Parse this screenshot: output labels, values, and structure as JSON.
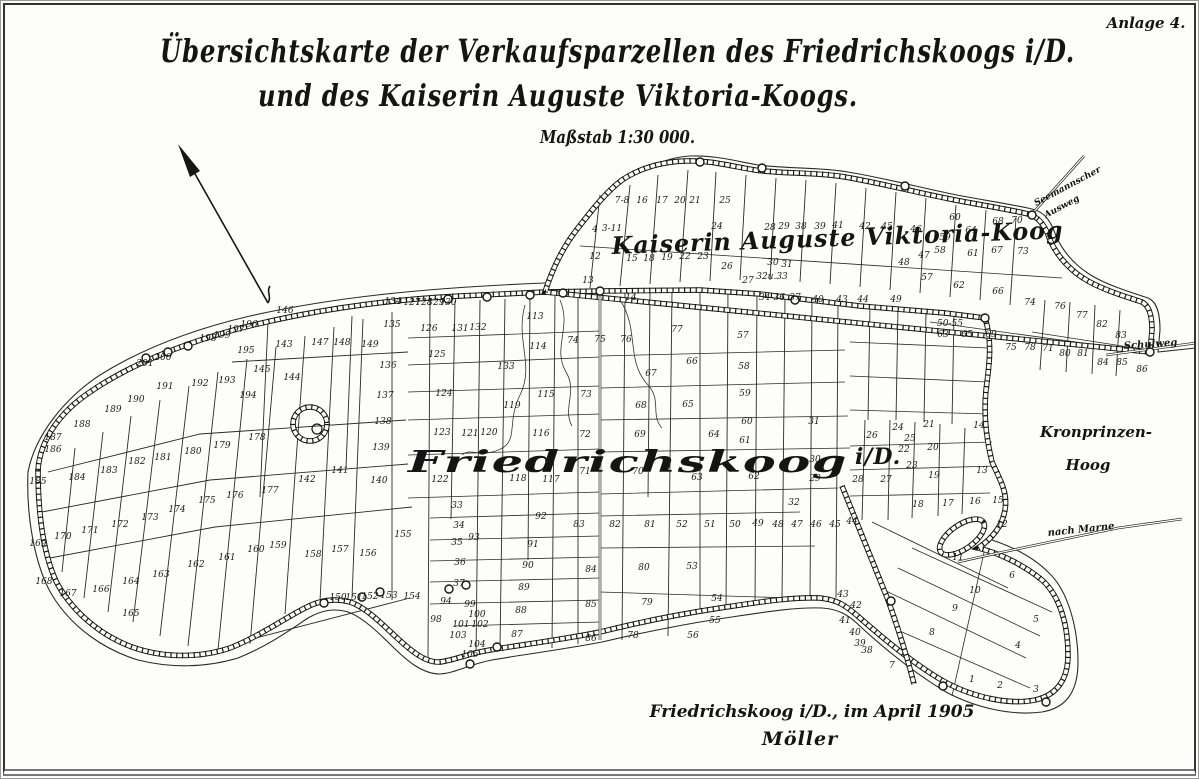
{
  "frame": {
    "annotation": "Anlage 4."
  },
  "title": {
    "line1": "Übersichtskarte der Verkaufsparzellen des Friedrichskoogs i/D.",
    "line2": "und des Kaiserin Auguste Viktoria-Koogs.",
    "scale": "Maßstab 1:30 000."
  },
  "footer": {
    "place_date": "Friedrichskoog i/D., im April 1905",
    "signature": "Möller"
  },
  "map": {
    "labels": {
      "kav_koog": "Kaiserin Auguste Viktoria-Koog",
      "friedrichskoog": "Friedrichskoog",
      "fk_suffix": "i/D.",
      "kronprinzen_line1": "Kronprinzen-",
      "kronprinzen_line2": "Hoog",
      "nach_marne": "nach Marne",
      "schulweg": "Schulweg",
      "ausweg_line1": "Seemannscher",
      "ausweg_line2": "Ausweg"
    },
    "parcels": [
      {
        "n": "1",
        "x": 972,
        "y": 682
      },
      {
        "n": "2",
        "x": 1000,
        "y": 688
      },
      {
        "n": "3",
        "x": 1036,
        "y": 692
      },
      {
        "n": "4",
        "x": 1018,
        "y": 648
      },
      {
        "n": "5",
        "x": 1036,
        "y": 622
      },
      {
        "n": "6",
        "x": 1012,
        "y": 578
      },
      {
        "n": "7",
        "x": 892,
        "y": 668
      },
      {
        "n": "8",
        "x": 932,
        "y": 635
      },
      {
        "n": "9",
        "x": 955,
        "y": 611
      },
      {
        "n": "10",
        "x": 975,
        "y": 593
      },
      {
        "n": "11",
        "x": 958,
        "y": 560
      },
      {
        "n": "12",
        "x": 1002,
        "y": 527
      },
      {
        "n": "13",
        "x": 982,
        "y": 473
      },
      {
        "n": "14",
        "x": 979,
        "y": 428
      },
      {
        "n": "15",
        "x": 998,
        "y": 503
      },
      {
        "n": "16",
        "x": 975,
        "y": 504
      },
      {
        "n": "17",
        "x": 948,
        "y": 506
      },
      {
        "n": "18",
        "x": 918,
        "y": 507
      },
      {
        "n": "19",
        "x": 934,
        "y": 478
      },
      {
        "n": "20",
        "x": 933,
        "y": 450
      },
      {
        "n": "21",
        "x": 929,
        "y": 427
      },
      {
        "n": "22",
        "x": 904,
        "y": 452
      },
      {
        "n": "23",
        "x": 912,
        "y": 468
      },
      {
        "n": "24",
        "x": 898,
        "y": 430
      },
      {
        "n": "25",
        "x": 910,
        "y": 441
      },
      {
        "n": "26",
        "x": 872,
        "y": 438
      },
      {
        "n": "27",
        "x": 886,
        "y": 482
      },
      {
        "n": "28",
        "x": 858,
        "y": 482
      },
      {
        "n": "29",
        "x": 815,
        "y": 481
      },
      {
        "n": "30",
        "x": 815,
        "y": 462
      },
      {
        "n": "31",
        "x": 814,
        "y": 424
      },
      {
        "n": "32",
        "x": 794,
        "y": 505
      },
      {
        "n": "33",
        "x": 457,
        "y": 508
      },
      {
        "n": "34",
        "x": 459,
        "y": 528
      },
      {
        "n": "35",
        "x": 457,
        "y": 545
      },
      {
        "n": "36",
        "x": 460,
        "y": 565
      },
      {
        "n": "37",
        "x": 459,
        "y": 586
      },
      {
        "n": "38",
        "x": 867,
        "y": 653
      },
      {
        "n": "39",
        "x": 860,
        "y": 646
      },
      {
        "n": "40",
        "x": 855,
        "y": 635
      },
      {
        "n": "41",
        "x": 845,
        "y": 623
      },
      {
        "n": "42",
        "x": 856,
        "y": 608
      },
      {
        "n": "43",
        "x": 843,
        "y": 597
      },
      {
        "n": "44",
        "x": 852,
        "y": 524
      },
      {
        "n": "45",
        "x": 835,
        "y": 527
      },
      {
        "n": "46",
        "x": 816,
        "y": 527
      },
      {
        "n": "47",
        "x": 797,
        "y": 527
      },
      {
        "n": "48",
        "x": 778,
        "y": 527
      },
      {
        "n": "49",
        "x": 758,
        "y": 526
      },
      {
        "n": "50",
        "x": 735,
        "y": 527
      },
      {
        "n": "51",
        "x": 710,
        "y": 527
      },
      {
        "n": "52",
        "x": 682,
        "y": 527
      },
      {
        "n": "53",
        "x": 692,
        "y": 569
      },
      {
        "n": "54",
        "x": 717,
        "y": 601
      },
      {
        "n": "55",
        "x": 715,
        "y": 623
      },
      {
        "n": "56",
        "x": 693,
        "y": 638
      },
      {
        "n": "57",
        "x": 743,
        "y": 338
      },
      {
        "n": "58",
        "x": 744,
        "y": 369
      },
      {
        "n": "59",
        "x": 745,
        "y": 396
      },
      {
        "n": "60",
        "x": 747,
        "y": 424
      },
      {
        "n": "61",
        "x": 745,
        "y": 443
      },
      {
        "n": "62",
        "x": 754,
        "y": 479
      },
      {
        "n": "63",
        "x": 697,
        "y": 480
      },
      {
        "n": "64",
        "x": 714,
        "y": 437
      },
      {
        "n": "65",
        "x": 688,
        "y": 407
      },
      {
        "n": "66",
        "x": 692,
        "y": 364
      },
      {
        "n": "67",
        "x": 651,
        "y": 376
      },
      {
        "n": "68",
        "x": 641,
        "y": 408
      },
      {
        "n": "69",
        "x": 640,
        "y": 437
      },
      {
        "n": "70",
        "x": 638,
        "y": 474
      },
      {
        "n": "71",
        "x": 585,
        "y": 474
      },
      {
        "n": "72",
        "x": 585,
        "y": 437
      },
      {
        "n": "73",
        "x": 586,
        "y": 397
      },
      {
        "n": "74",
        "x": 573,
        "y": 343
      },
      {
        "n": "75",
        "x": 600,
        "y": 342
      },
      {
        "n": "76",
        "x": 626,
        "y": 342
      },
      {
        "n": "77",
        "x": 677,
        "y": 332
      },
      {
        "n": "78",
        "x": 633,
        "y": 638
      },
      {
        "n": "79",
        "x": 647,
        "y": 605
      },
      {
        "n": "80",
        "x": 644,
        "y": 570
      },
      {
        "n": "81",
        "x": 650,
        "y": 527
      },
      {
        "n": "82",
        "x": 615,
        "y": 527
      },
      {
        "n": "83",
        "x": 579,
        "y": 527
      },
      {
        "n": "84",
        "x": 591,
        "y": 572
      },
      {
        "n": "85",
        "x": 591,
        "y": 607
      },
      {
        "n": "86",
        "x": 591,
        "y": 641
      },
      {
        "n": "87",
        "x": 517,
        "y": 637
      },
      {
        "n": "88",
        "x": 521,
        "y": 613
      },
      {
        "n": "89",
        "x": 524,
        "y": 590
      },
      {
        "n": "90",
        "x": 528,
        "y": 568
      },
      {
        "n": "91",
        "x": 533,
        "y": 547
      },
      {
        "n": "92",
        "x": 541,
        "y": 519
      },
      {
        "n": "93",
        "x": 474,
        "y": 540
      },
      {
        "n": "94",
        "x": 446,
        "y": 604
      },
      {
        "n": "98",
        "x": 436,
        "y": 622
      },
      {
        "n": "99",
        "x": 470,
        "y": 607
      },
      {
        "n": "100",
        "x": 477,
        "y": 617
      },
      {
        "n": "101",
        "x": 461,
        "y": 627
      },
      {
        "n": "102",
        "x": 480,
        "y": 627
      },
      {
        "n": "103",
        "x": 458,
        "y": 638
      },
      {
        "n": "104",
        "x": 477,
        "y": 647
      },
      {
        "n": "105",
        "x": 470,
        "y": 657
      },
      {
        "n": "113",
        "x": 535,
        "y": 319
      },
      {
        "n": "114",
        "x": 538,
        "y": 349
      },
      {
        "n": "115",
        "x": 546,
        "y": 397
      },
      {
        "n": "116",
        "x": 541,
        "y": 436
      },
      {
        "n": "117",
        "x": 551,
        "y": 482
      },
      {
        "n": "118",
        "x": 518,
        "y": 481
      },
      {
        "n": "119",
        "x": 512,
        "y": 408
      },
      {
        "n": "120",
        "x": 489,
        "y": 435
      },
      {
        "n": "121",
        "x": 470,
        "y": 436
      },
      {
        "n": "122",
        "x": 440,
        "y": 482
      },
      {
        "n": "123",
        "x": 442,
        "y": 435
      },
      {
        "n": "124",
        "x": 444,
        "y": 396
      },
      {
        "n": "125",
        "x": 437,
        "y": 357
      },
      {
        "n": "126",
        "x": 429,
        "y": 331
      },
      {
        "n": "127",
        "x": 412,
        "y": 305
      },
      {
        "n": "128",
        "x": 424,
        "y": 305
      },
      {
        "n": "129",
        "x": 436,
        "y": 305
      },
      {
        "n": "130",
        "x": 448,
        "y": 305
      },
      {
        "n": "131",
        "x": 460,
        "y": 331
      },
      {
        "n": "132",
        "x": 478,
        "y": 330
      },
      {
        "n": "133",
        "x": 506,
        "y": 369
      },
      {
        "n": "134",
        "x": 393,
        "y": 304
      },
      {
        "n": "135",
        "x": 392,
        "y": 327
      },
      {
        "n": "136",
        "x": 388,
        "y": 368
      },
      {
        "n": "137",
        "x": 385,
        "y": 398
      },
      {
        "n": "138",
        "x": 383,
        "y": 424
      },
      {
        "n": "139",
        "x": 381,
        "y": 450
      },
      {
        "n": "140",
        "x": 379,
        "y": 483
      },
      {
        "n": "141",
        "x": 340,
        "y": 473
      },
      {
        "n": "142",
        "x": 307,
        "y": 482
      },
      {
        "n": "143",
        "x": 284,
        "y": 347
      },
      {
        "n": "144",
        "x": 292,
        "y": 380
      },
      {
        "n": "145",
        "x": 262,
        "y": 372
      },
      {
        "n": "146",
        "x": 285,
        "y": 313
      },
      {
        "n": "147",
        "x": 320,
        "y": 345
      },
      {
        "n": "148",
        "x": 342,
        "y": 345
      },
      {
        "n": "149",
        "x": 370,
        "y": 347
      },
      {
        "n": "150",
        "x": 338,
        "y": 600
      },
      {
        "n": "151",
        "x": 354,
        "y": 600
      },
      {
        "n": "152",
        "x": 370,
        "y": 599
      },
      {
        "n": "153",
        "x": 389,
        "y": 598
      },
      {
        "n": "154",
        "x": 412,
        "y": 599
      },
      {
        "n": "155",
        "x": 403,
        "y": 537
      },
      {
        "n": "156",
        "x": 368,
        "y": 556
      },
      {
        "n": "157",
        "x": 340,
        "y": 552
      },
      {
        "n": "158",
        "x": 313,
        "y": 557
      },
      {
        "n": "159",
        "x": 278,
        "y": 548
      },
      {
        "n": "160",
        "x": 256,
        "y": 552
      },
      {
        "n": "161",
        "x": 227,
        "y": 560
      },
      {
        "n": "162",
        "x": 196,
        "y": 567
      },
      {
        "n": "163",
        "x": 161,
        "y": 577
      },
      {
        "n": "164",
        "x": 131,
        "y": 584
      },
      {
        "n": "165",
        "x": 131,
        "y": 616
      },
      {
        "n": "166",
        "x": 101,
        "y": 592
      },
      {
        "n": "167",
        "x": 68,
        "y": 596
      },
      {
        "n": "168",
        "x": 44,
        "y": 584
      },
      {
        "n": "169",
        "x": 38,
        "y": 546
      },
      {
        "n": "170",
        "x": 63,
        "y": 539
      },
      {
        "n": "171",
        "x": 90,
        "y": 533
      },
      {
        "n": "172",
        "x": 120,
        "y": 527
      },
      {
        "n": "173",
        "x": 150,
        "y": 520
      },
      {
        "n": "174",
        "x": 177,
        "y": 512
      },
      {
        "n": "175",
        "x": 207,
        "y": 503
      },
      {
        "n": "176",
        "x": 235,
        "y": 498
      },
      {
        "n": "177",
        "x": 270,
        "y": 493
      },
      {
        "n": "178",
        "x": 257,
        "y": 440
      },
      {
        "n": "179",
        "x": 222,
        "y": 448
      },
      {
        "n": "180",
        "x": 193,
        "y": 454
      },
      {
        "n": "181",
        "x": 163,
        "y": 460
      },
      {
        "n": "182",
        "x": 137,
        "y": 464
      },
      {
        "n": "183",
        "x": 109,
        "y": 473
      },
      {
        "n": "184",
        "x": 77,
        "y": 480
      },
      {
        "n": "185",
        "x": 38,
        "y": 484
      },
      {
        "n": "186",
        "x": 53,
        "y": 452
      },
      {
        "n": "187",
        "x": 53,
        "y": 440
      },
      {
        "n": "188",
        "x": 82,
        "y": 427
      },
      {
        "n": "189",
        "x": 113,
        "y": 412
      },
      {
        "n": "190",
        "x": 136,
        "y": 402
      },
      {
        "n": "191",
        "x": 165,
        "y": 389
      },
      {
        "n": "192",
        "x": 200,
        "y": 386
      },
      {
        "n": "193",
        "x": 227,
        "y": 383
      },
      {
        "n": "194",
        "x": 248,
        "y": 398
      },
      {
        "n": "195",
        "x": 246,
        "y": 353
      },
      {
        "n": "196",
        "x": 249,
        "y": 327
      },
      {
        "n": "197",
        "x": 236,
        "y": 332
      },
      {
        "n": "198",
        "x": 208,
        "y": 341
      },
      {
        "n": "199",
        "x": 222,
        "y": 338
      },
      {
        "n": "200",
        "x": 163,
        "y": 360
      },
      {
        "n": "201",
        "x": 145,
        "y": 366
      },
      {
        "n": "7-8",
        "x": 622,
        "y": 203
      },
      {
        "n": "16",
        "x": 642,
        "y": 203
      },
      {
        "n": "17",
        "x": 662,
        "y": 203
      },
      {
        "n": "20",
        "x": 680,
        "y": 203
      },
      {
        "n": "21",
        "x": 695,
        "y": 203
      },
      {
        "n": "25",
        "x": 725,
        "y": 203
      },
      {
        "n": "24",
        "x": 717,
        "y": 229
      },
      {
        "n": "4",
        "x": 595,
        "y": 232
      },
      {
        "n": "3-11",
        "x": 612,
        "y": 231
      },
      {
        "n": "12",
        "x": 595,
        "y": 259
      },
      {
        "n": "13",
        "x": 588,
        "y": 283
      },
      {
        "n": "14",
        "x": 631,
        "y": 300
      },
      {
        "n": "15",
        "x": 632,
        "y": 261
      },
      {
        "n": "18",
        "x": 649,
        "y": 261
      },
      {
        "n": "19",
        "x": 667,
        "y": 260
      },
      {
        "n": "22",
        "x": 685,
        "y": 259
      },
      {
        "n": "23",
        "x": 703,
        "y": 259
      },
      {
        "n": "26",
        "x": 727,
        "y": 269
      },
      {
        "n": "27",
        "x": 748,
        "y": 283
      },
      {
        "n": "28",
        "x": 770,
        "y": 230
      },
      {
        "n": "29",
        "x": 784,
        "y": 229
      },
      {
        "n": "30",
        "x": 773,
        "y": 265
      },
      {
        "n": "31",
        "x": 787,
        "y": 267
      },
      {
        "n": "32u.33",
        "x": 772,
        "y": 279
      },
      {
        "n": "34-36",
        "x": 772,
        "y": 300
      },
      {
        "n": "37",
        "x": 795,
        "y": 300
      },
      {
        "n": "38",
        "x": 801,
        "y": 229
      },
      {
        "n": "39",
        "x": 820,
        "y": 229
      },
      {
        "n": "40",
        "x": 818,
        "y": 302
      },
      {
        "n": "41",
        "x": 838,
        "y": 228
      },
      {
        "n": "42",
        "x": 865,
        "y": 229
      },
      {
        "n": "43",
        "x": 842,
        "y": 302
      },
      {
        "n": "44",
        "x": 863,
        "y": 302
      },
      {
        "n": "45",
        "x": 887,
        "y": 229
      },
      {
        "n": "46",
        "x": 916,
        "y": 232
      },
      {
        "n": "47",
        "x": 924,
        "y": 258
      },
      {
        "n": "48",
        "x": 904,
        "y": 265
      },
      {
        "n": "49",
        "x": 896,
        "y": 302
      },
      {
        "n": "50-55",
        "x": 950,
        "y": 326
      },
      {
        "n": "57",
        "x": 927,
        "y": 280
      },
      {
        "n": "58",
        "x": 940,
        "y": 253
      },
      {
        "n": "59",
        "x": 945,
        "y": 240
      },
      {
        "n": "60",
        "x": 955,
        "y": 220
      },
      {
        "n": "61",
        "x": 973,
        "y": 256
      },
      {
        "n": "62",
        "x": 959,
        "y": 288
      },
      {
        "n": "63",
        "x": 943,
        "y": 337
      },
      {
        "n": "64",
        "x": 971,
        "y": 233
      },
      {
        "n": "65",
        "x": 967,
        "y": 337
      },
      {
        "n": "66",
        "x": 998,
        "y": 294
      },
      {
        "n": "67",
        "x": 997,
        "y": 253
      },
      {
        "n": "68",
        "x": 998,
        "y": 224
      },
      {
        "n": "69",
        "x": 991,
        "y": 337
      },
      {
        "n": "70",
        "x": 1017,
        "y": 223
      },
      {
        "n": "71",
        "x": 1048,
        "y": 351
      },
      {
        "n": "73",
        "x": 1023,
        "y": 254
      },
      {
        "n": "74",
        "x": 1030,
        "y": 305
      },
      {
        "n": "75",
        "x": 1011,
        "y": 350
      },
      {
        "n": "76",
        "x": 1060,
        "y": 309
      },
      {
        "n": "77",
        "x": 1082,
        "y": 318
      },
      {
        "n": "78",
        "x": 1030,
        "y": 350
      },
      {
        "n": "80",
        "x": 1065,
        "y": 356
      },
      {
        "n": "81",
        "x": 1083,
        "y": 356
      },
      {
        "n": "82",
        "x": 1102,
        "y": 327
      },
      {
        "n": "83",
        "x": 1121,
        "y": 338
      },
      {
        "n": "84",
        "x": 1103,
        "y": 365
      },
      {
        "n": "85",
        "x": 1122,
        "y": 365
      },
      {
        "n": "86",
        "x": 1142,
        "y": 372
      }
    ]
  }
}
